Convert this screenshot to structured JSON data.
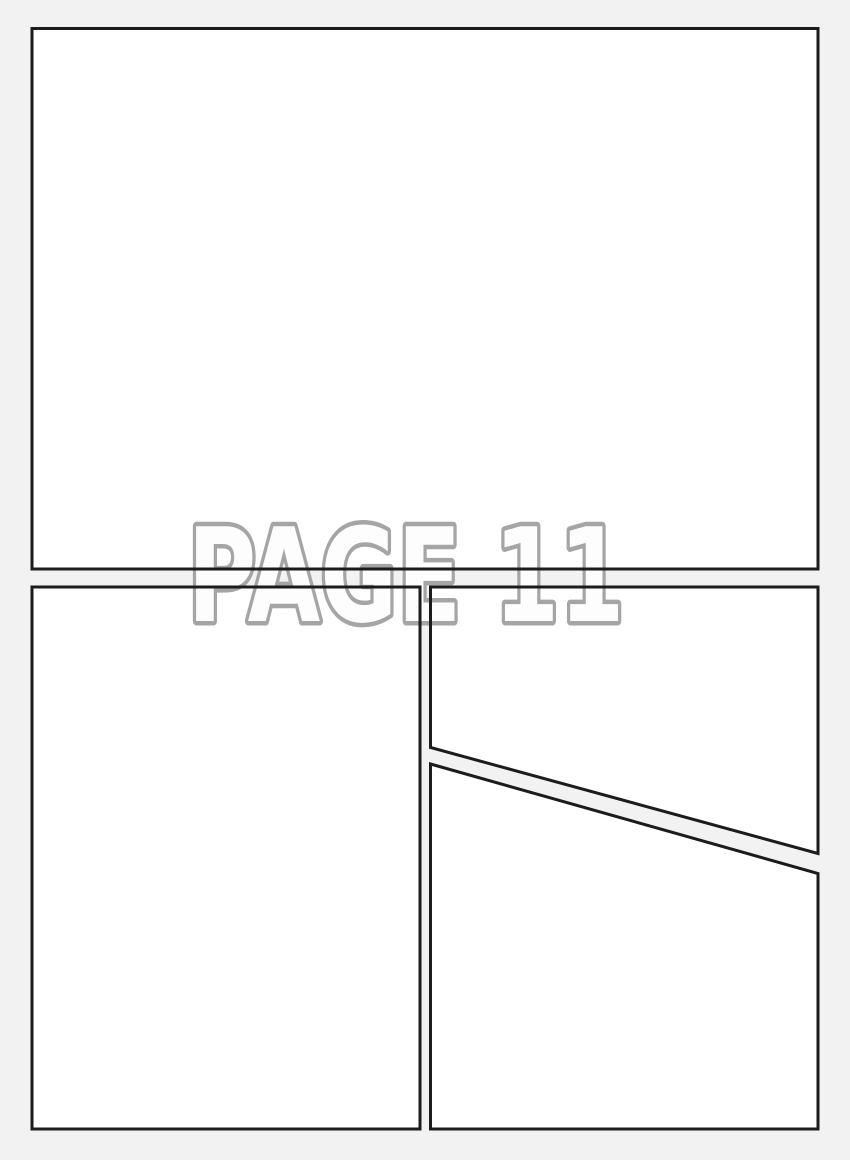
{
  "page": {
    "label": "PAGE 11"
  },
  "colors": {
    "background": "#f2f2f2",
    "panel_fill": "#ffffff",
    "panel_border": "#1c1c1c",
    "label_fill": "#fdfdfd",
    "label_outline": "#a5a5a5"
  }
}
